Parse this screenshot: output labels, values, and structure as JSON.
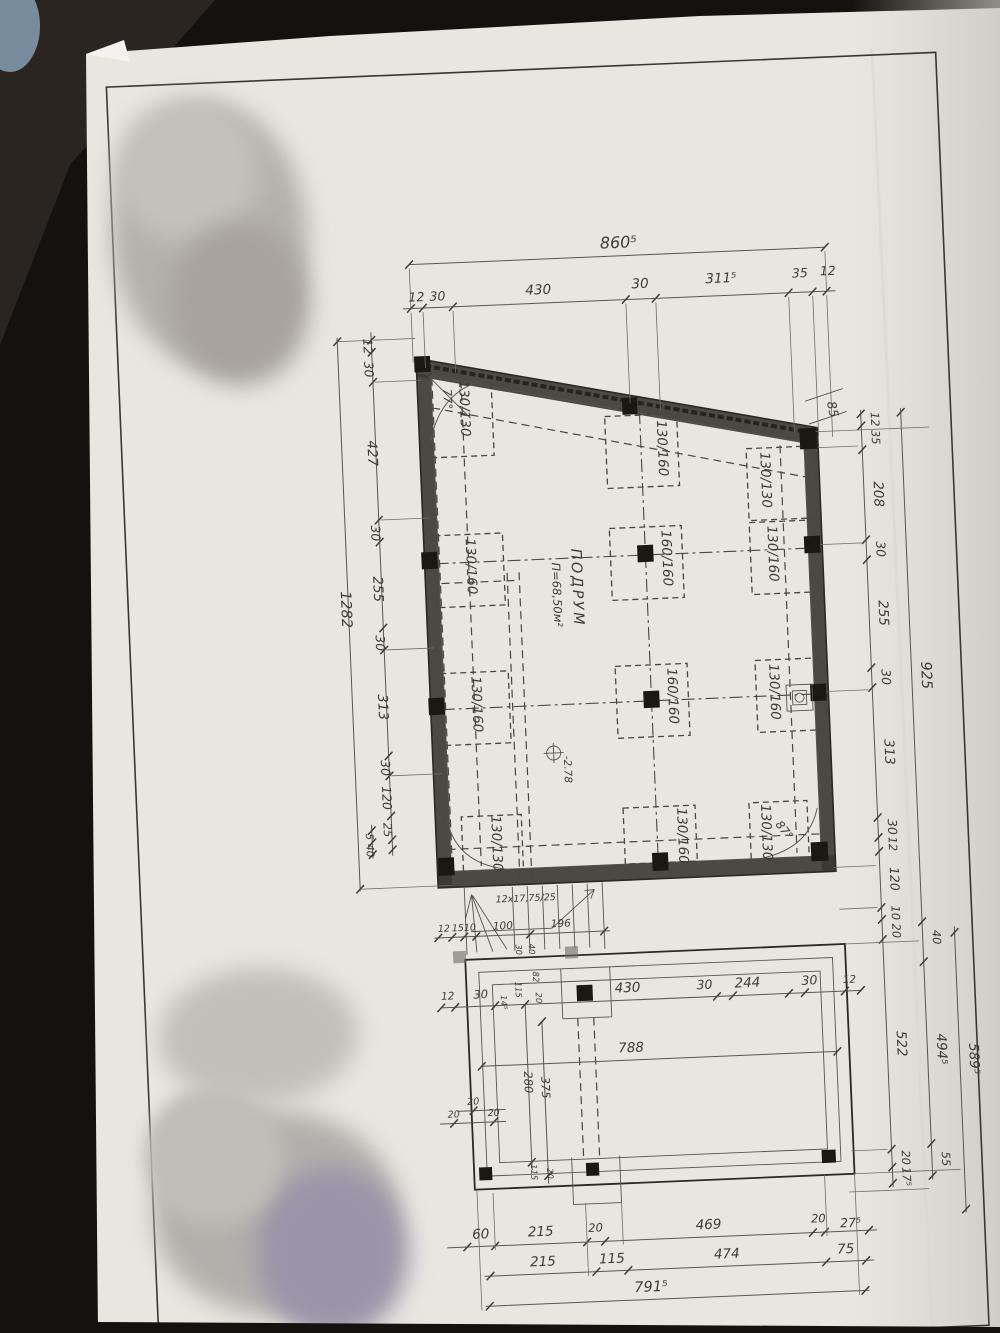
{
  "room": {
    "name": "ПОДРУМ",
    "area": "П=68,50м²",
    "level": "-2.78"
  },
  "angles": {
    "top_left": "77°",
    "bottom_right": "87°"
  },
  "footings": {
    "r1": [
      "130/130",
      "130/160",
      "130/130"
    ],
    "r2": [
      "130/160",
      "160/160",
      "130/160"
    ],
    "r3": [
      "130/160",
      "160/160",
      "130/160"
    ],
    "r4": [
      "130/130",
      "130/160",
      "130/130"
    ]
  },
  "stair": {
    "note": "12x17,75/25",
    "chain": [
      "12",
      "15",
      "10",
      "100",
      "196"
    ]
  },
  "dims": {
    "top": {
      "total": "860⁵",
      "chain": [
        "12",
        "30",
        "430",
        "30",
        "311⁵",
        "35",
        "12"
      ]
    },
    "left": {
      "total": "1282",
      "chain": [
        "12",
        "30",
        "427",
        "30",
        "255",
        "30",
        "313",
        "30",
        "120",
        "25"
      ],
      "extra": [
        "5",
        "40"
      ]
    },
    "right": {
      "slant": "85",
      "chain": [
        "12",
        "35",
        "208",
        "30",
        "255",
        "30",
        "313",
        "30",
        "12",
        "120",
        "10",
        "20"
      ],
      "lower": [
        "522",
        "20",
        "17⁵"
      ],
      "mid": [
        "925",
        "40",
        "494⁵",
        "55"
      ],
      "outer": "589⁵"
    },
    "bottom": {
      "chain1": [
        "60",
        "215",
        "20",
        "469",
        "20",
        "27⁵"
      ],
      "chain2": [
        "215",
        "115",
        "474",
        "75"
      ],
      "total": "791⁵"
    },
    "lower": {
      "chain": [
        "12",
        "30",
        "430",
        "30",
        "244",
        "30",
        "12"
      ],
      "span": "788",
      "vertical": [
        "280",
        "375"
      ],
      "small": [
        "30",
        "40",
        "82",
        "20",
        "115",
        "14⁵"
      ],
      "corner": [
        "20",
        "20",
        "20"
      ],
      "bottom_small": [
        "115",
        "20"
      ]
    }
  }
}
